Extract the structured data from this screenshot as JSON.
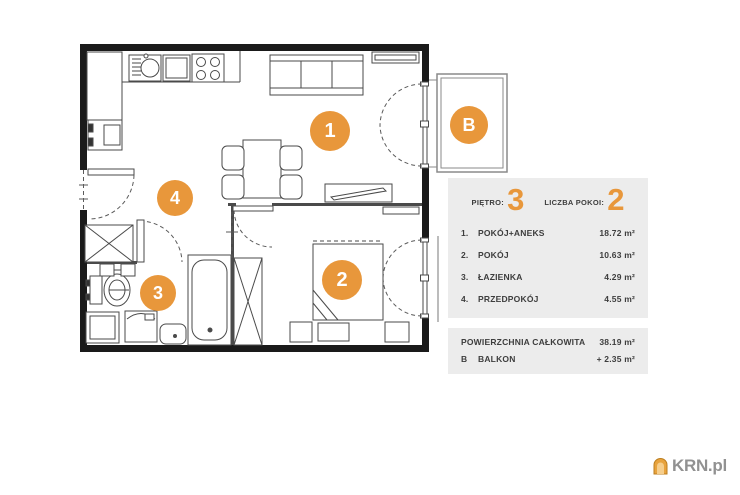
{
  "accent_color": "#E8973B",
  "panel_bg_color": "#ECECEC",
  "plan": {
    "markers": [
      {
        "label": "1"
      },
      {
        "label": "2"
      },
      {
        "label": "3"
      },
      {
        "label": "4"
      },
      {
        "label": "B"
      }
    ]
  },
  "info_panel": {
    "floor_label": "PIĘTRO:",
    "floor_value": "3",
    "rooms_count_label": "LICZBA POKOI:",
    "rooms_count_value": "2",
    "rooms": [
      {
        "index": "1.",
        "name": "POKÓJ+ANEKS",
        "area": "18.72 m²"
      },
      {
        "index": "2.",
        "name": "POKÓJ",
        "area": "10.63 m²"
      },
      {
        "index": "3.",
        "name": "ŁAZIENKA",
        "area": "4.29 m²"
      },
      {
        "index": "4.",
        "name": "PRZEDPOKÓJ",
        "area": "4.55 m²"
      }
    ],
    "total_label": "POWIERZCHNIA CAŁKOWITA",
    "total_value": "38.19 m²",
    "balcony_index": "B",
    "balcony_label": "BALKON",
    "balcony_value": "+ 2.35 m²"
  },
  "logo": {
    "text": "KRN.pl"
  }
}
